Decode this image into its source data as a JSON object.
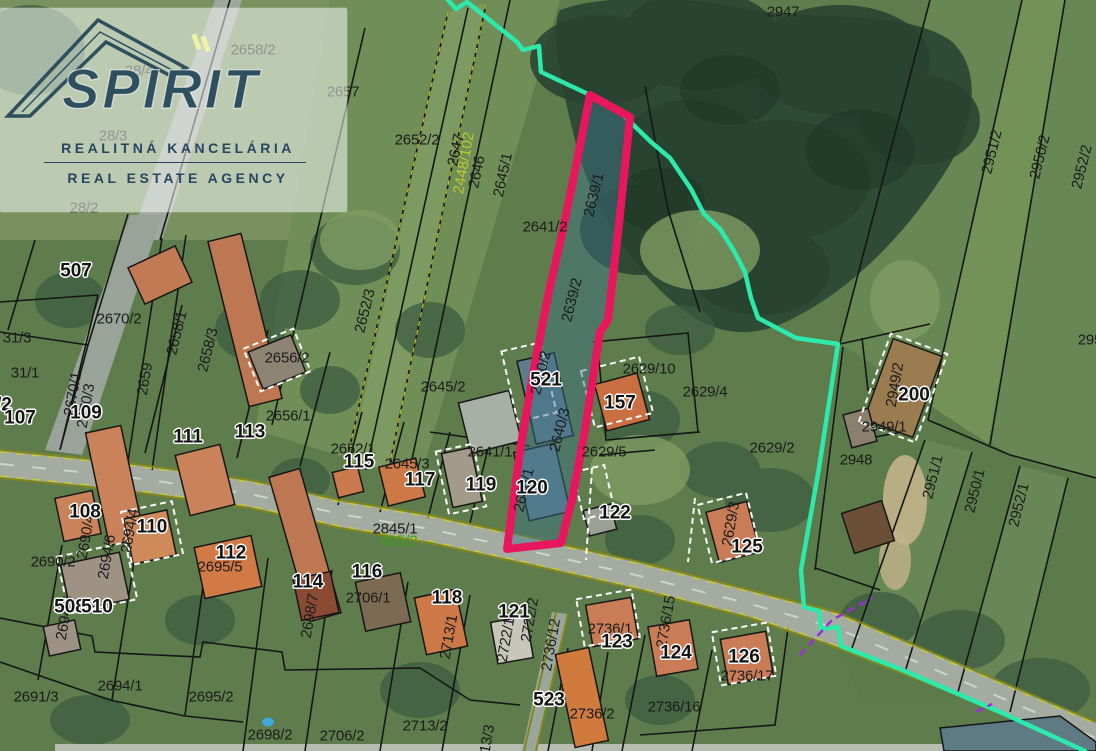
{
  "watermark": {
    "brand": "SPIRIT",
    "line1": "REALITNÁ KANCELÁRIA",
    "line2": "REAL ESTATE AGENCY"
  },
  "map": {
    "type": "cadastral-aerial",
    "highlighted_parcel": "2639/1",
    "colors": {
      "highlight": "#e8175d",
      "highlight_fill": "rgba(62,112,140,0.45)",
      "boundary": "#2de9ac",
      "utility": "#9a2fd6",
      "label_green": "#3e9e20",
      "label_yellow": "#bcc92b"
    },
    "labels": [
      {
        "t": "2947",
        "x": 783,
        "y": 12
      },
      {
        "t": "2658/2",
        "x": 253,
        "y": 50
      },
      {
        "t": "2657",
        "x": 343,
        "y": 92
      },
      {
        "t": "28/4",
        "x": 139,
        "y": 71
      },
      {
        "t": "28/3",
        "x": 113,
        "y": 136
      },
      {
        "t": "28/2",
        "x": 84,
        "y": 208
      },
      {
        "t": "2652/2",
        "x": 417,
        "y": 140
      },
      {
        "t": "2647",
        "x": 456,
        "y": 150,
        "r": -78
      },
      {
        "t": "2646",
        "x": 477,
        "y": 172,
        "r": -78
      },
      {
        "t": "2645/1",
        "x": 503,
        "y": 175,
        "r": -78
      },
      {
        "t": "2448/102",
        "x": 464,
        "y": 163,
        "r": -80,
        "s": "y"
      },
      {
        "t": "2641/2",
        "x": 545,
        "y": 227
      },
      {
        "t": "2639/1",
        "x": 594,
        "y": 195,
        "r": -76
      },
      {
        "t": "2639/2",
        "x": 572,
        "y": 300,
        "r": -76
      },
      {
        "t": "2652/3",
        "x": 365,
        "y": 311,
        "r": -76
      },
      {
        "t": "2656/2",
        "x": 287,
        "y": 358
      },
      {
        "t": "2656/1",
        "x": 288,
        "y": 416
      },
      {
        "t": "2658/1",
        "x": 177,
        "y": 333,
        "r": -76
      },
      {
        "t": "2658/3",
        "x": 208,
        "y": 350,
        "r": -76
      },
      {
        "t": "2670/2",
        "x": 119,
        "y": 319
      },
      {
        "t": "2659",
        "x": 145,
        "y": 379,
        "r": -80
      },
      {
        "t": "2670/1",
        "x": 73,
        "y": 394,
        "r": -80
      },
      {
        "t": "2670/3",
        "x": 86,
        "y": 406,
        "r": -80
      },
      {
        "t": "31/3",
        "x": 17,
        "y": 338
      },
      {
        "t": "31/1",
        "x": 25,
        "y": 373
      },
      {
        "t": "/2",
        "x": 4,
        "y": 405,
        "s": "h"
      },
      {
        "t": "2645/2",
        "x": 443,
        "y": 387
      },
      {
        "t": "2641/1",
        "x": 490,
        "y": 452
      },
      {
        "t": "2645/3",
        "x": 407,
        "y": 464
      },
      {
        "t": "2652/1",
        "x": 353,
        "y": 449
      },
      {
        "t": "2629/10",
        "x": 649,
        "y": 369
      },
      {
        "t": "2629/4",
        "x": 705,
        "y": 392
      },
      {
        "t": "2629/5",
        "x": 604,
        "y": 452
      },
      {
        "t": "2640/2",
        "x": 541,
        "y": 373,
        "r": -76
      },
      {
        "t": "2640/3",
        "x": 560,
        "y": 430,
        "r": -76
      },
      {
        "t": "2640/1",
        "x": 524,
        "y": 490,
        "r": -76
      },
      {
        "t": "2629/2",
        "x": 772,
        "y": 448
      },
      {
        "t": "2629/3",
        "x": 731,
        "y": 524,
        "r": -80
      },
      {
        "t": "2845/1",
        "x": 395,
        "y": 529
      },
      {
        "t": "405/2",
        "x": 399,
        "y": 541,
        "s": "g"
      },
      {
        "t": "2690/2",
        "x": 53,
        "y": 562
      },
      {
        "t": "2690/4",
        "x": 86,
        "y": 537,
        "r": -80
      },
      {
        "t": "2694/4",
        "x": 130,
        "y": 531,
        "r": -80
      },
      {
        "t": "2694/6",
        "x": 107,
        "y": 557,
        "r": -80
      },
      {
        "t": "2694/3",
        "x": 65,
        "y": 618,
        "r": -80
      },
      {
        "t": "2695/5",
        "x": 220,
        "y": 567
      },
      {
        "t": "2694/1",
        "x": 120,
        "y": 686
      },
      {
        "t": "2691/3",
        "x": 36,
        "y": 697
      },
      {
        "t": "2695/2",
        "x": 211,
        "y": 697
      },
      {
        "t": "2698/2",
        "x": 270,
        "y": 735
      },
      {
        "t": "2706/1",
        "x": 368,
        "y": 598
      },
      {
        "t": "2706/2",
        "x": 342,
        "y": 736
      },
      {
        "t": "2698/7",
        "x": 310,
        "y": 616,
        "r": -80
      },
      {
        "t": "2713/1",
        "x": 449,
        "y": 637,
        "r": -80
      },
      {
        "t": "2713/2",
        "x": 425,
        "y": 726
      },
      {
        "t": "2713/3",
        "x": 486,
        "y": 747,
        "r": -80
      },
      {
        "t": "2722/1",
        "x": 506,
        "y": 640,
        "r": -80
      },
      {
        "t": "2722/2",
        "x": 530,
        "y": 620,
        "r": -80
      },
      {
        "t": "2736/12",
        "x": 551,
        "y": 645,
        "r": -80
      },
      {
        "t": "2736/1",
        "x": 610,
        "y": 629
      },
      {
        "t": "2736/15",
        "x": 666,
        "y": 622,
        "r": -80
      },
      {
        "t": "2736/16",
        "x": 674,
        "y": 707
      },
      {
        "t": "2736/17",
        "x": 747,
        "y": 676
      },
      {
        "t": "2736/2",
        "x": 592,
        "y": 714
      },
      {
        "t": "2948",
        "x": 856,
        "y": 460
      },
      {
        "t": "2949/1",
        "x": 884,
        "y": 427
      },
      {
        "t": "2949/2",
        "x": 895,
        "y": 385,
        "r": -80
      },
      {
        "t": "2951/1",
        "x": 933,
        "y": 477,
        "r": -76
      },
      {
        "t": "2950/1",
        "x": 975,
        "y": 491,
        "r": -76
      },
      {
        "t": "2952/1",
        "x": 1019,
        "y": 505,
        "r": -76
      },
      {
        "t": "2951/2",
        "x": 992,
        "y": 152,
        "r": -76
      },
      {
        "t": "2950/2",
        "x": 1040,
        "y": 157,
        "r": -76
      },
      {
        "t": "2952/2",
        "x": 1082,
        "y": 167,
        "r": -76
      },
      {
        "t": "295",
        "x": 1090,
        "y": 340
      },
      {
        "t": "507",
        "x": 76,
        "y": 271,
        "s": "h"
      },
      {
        "t": "107",
        "x": 20,
        "y": 418,
        "s": "h"
      },
      {
        "t": "109",
        "x": 86,
        "y": 413,
        "s": "h"
      },
      {
        "t": "111",
        "x": 188,
        "y": 437,
        "s": "h"
      },
      {
        "t": "113",
        "x": 250,
        "y": 432,
        "s": "h"
      },
      {
        "t": "115",
        "x": 359,
        "y": 462,
        "s": "h"
      },
      {
        "t": "117",
        "x": 420,
        "y": 480,
        "s": "h"
      },
      {
        "t": "119",
        "x": 481,
        "y": 485,
        "s": "h"
      },
      {
        "t": "120",
        "x": 532,
        "y": 488,
        "s": "h"
      },
      {
        "t": "521",
        "x": 546,
        "y": 380,
        "s": "h"
      },
      {
        "t": "157",
        "x": 620,
        "y": 403,
        "s": "h"
      },
      {
        "t": "122",
        "x": 615,
        "y": 513,
        "s": "h"
      },
      {
        "t": "125",
        "x": 747,
        "y": 547,
        "s": "h"
      },
      {
        "t": "200",
        "x": 914,
        "y": 395,
        "s": "h"
      },
      {
        "t": "108",
        "x": 85,
        "y": 512,
        "s": "h"
      },
      {
        "t": "110",
        "x": 152,
        "y": 527,
        "s": "h"
      },
      {
        "t": "112",
        "x": 231,
        "y": 553,
        "s": "h"
      },
      {
        "t": "508",
        "x": 70,
        "y": 607,
        "s": "h"
      },
      {
        "t": "510",
        "x": 97,
        "y": 607,
        "s": "h"
      },
      {
        "t": "114",
        "x": 308,
        "y": 582,
        "s": "h"
      },
      {
        "t": "116",
        "x": 367,
        "y": 572,
        "s": "h"
      },
      {
        "t": "118",
        "x": 447,
        "y": 598,
        "s": "h"
      },
      {
        "t": "121",
        "x": 514,
        "y": 612,
        "s": "h"
      },
      {
        "t": "123",
        "x": 617,
        "y": 642,
        "s": "h"
      },
      {
        "t": "124",
        "x": 676,
        "y": 653,
        "s": "h"
      },
      {
        "t": "126",
        "x": 744,
        "y": 657,
        "s": "h"
      },
      {
        "t": "523",
        "x": 549,
        "y": 700,
        "s": "h"
      }
    ]
  }
}
